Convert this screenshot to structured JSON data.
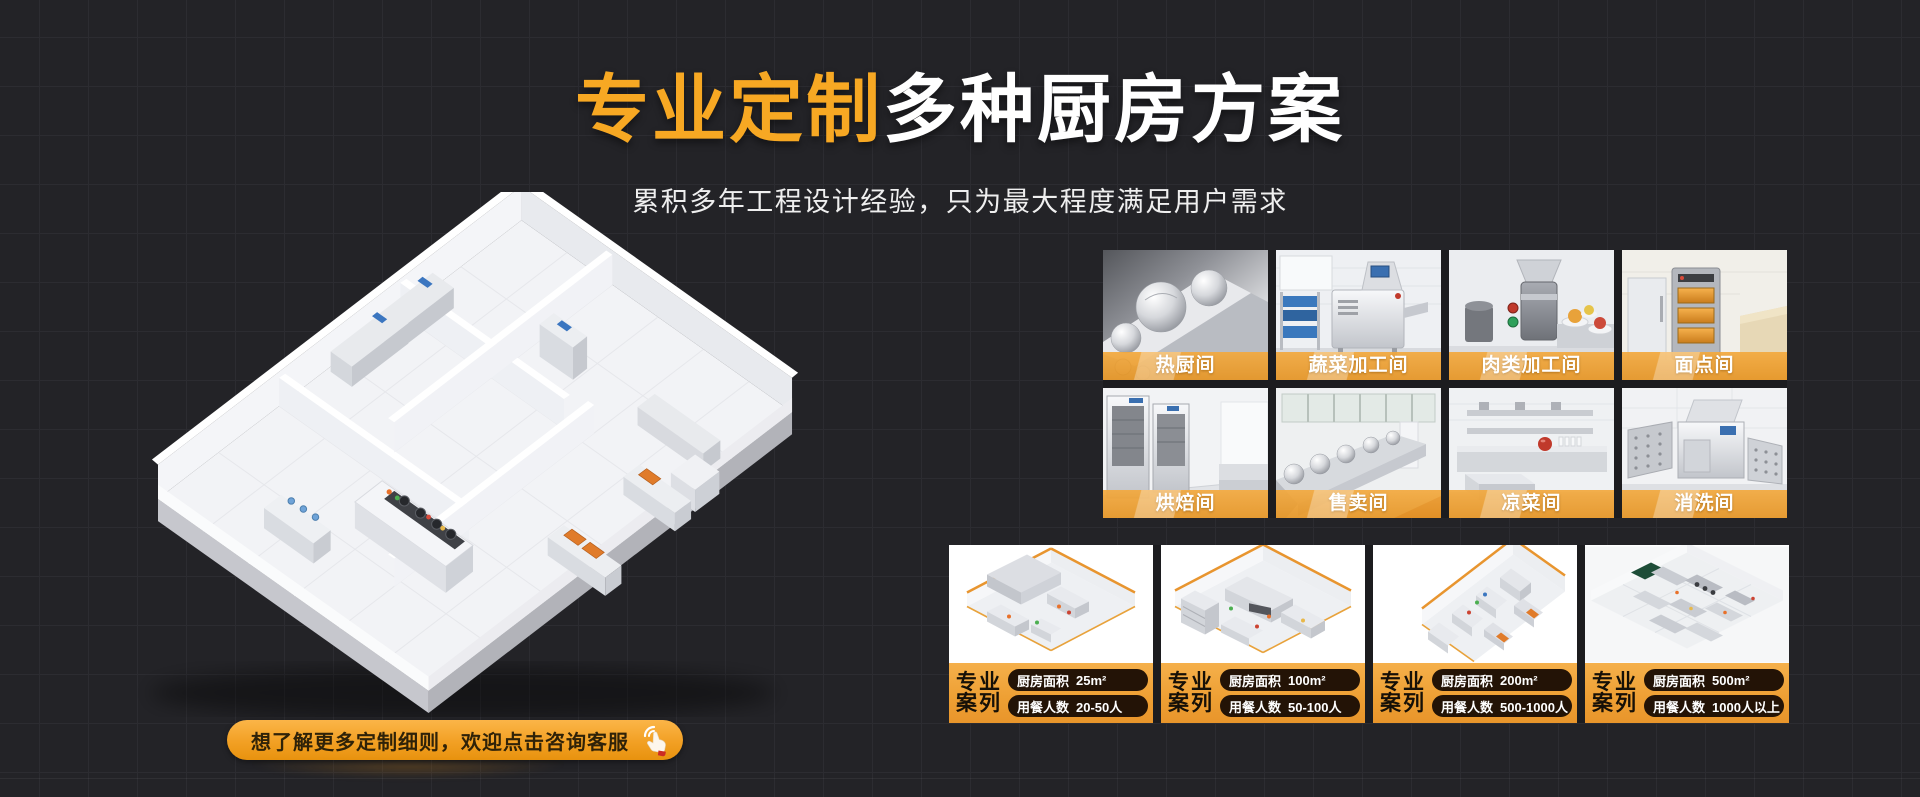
{
  "hero": {
    "title_highlight": "专业定制",
    "title_rest": "多种厨房方案",
    "subtitle": "累积多年工程设计经验，只为最大程度满足用户需求"
  },
  "cta": {
    "label": "想了解更多定制细则，欢迎点击咨询客服",
    "icon": "click-hand-icon"
  },
  "rooms": [
    {
      "label": "热厨间"
    },
    {
      "label": "蔬菜加工间"
    },
    {
      "label": "肉类加工间"
    },
    {
      "label": "面点间"
    },
    {
      "label": "烘焙间"
    },
    {
      "label": "售卖间"
    },
    {
      "label": "凉菜间"
    },
    {
      "label": "消洗间"
    }
  ],
  "cases": [
    {
      "badge_line1": "专业",
      "badge_line2": "案列",
      "area_label": "厨房面积",
      "area_value": "25m²",
      "diners_label": "用餐人数",
      "diners_value": "20-50人"
    },
    {
      "badge_line1": "专业",
      "badge_line2": "案列",
      "area_label": "厨房面积",
      "area_value": "100m²",
      "diners_label": "用餐人数",
      "diners_value": "50-100人"
    },
    {
      "badge_line1": "专业",
      "badge_line2": "案列",
      "area_label": "厨房面积",
      "area_value": "200m²",
      "diners_label": "用餐人数",
      "diners_value": "500-1000人"
    },
    {
      "badge_line1": "专业",
      "badge_line2": "案列",
      "area_label": "厨房面积",
      "area_value": "500m²",
      "diners_label": "用餐人数",
      "diners_value": "1000人以上"
    }
  ],
  "colors": {
    "accent_orange": "#F7A823",
    "label_bar_orange": "#E9A23B",
    "background": "#232327"
  }
}
